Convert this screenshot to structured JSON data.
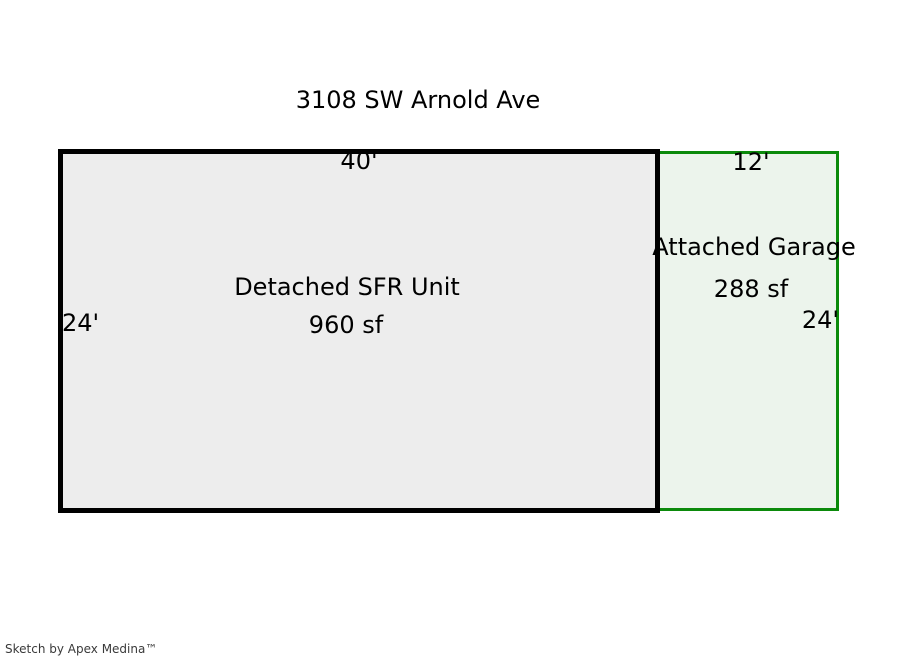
{
  "page": {
    "title": "3108 SW Arnold Ave",
    "footer_credit": "Sketch by Apex Medina™"
  },
  "sketch": {
    "main_unit": {
      "label": "Detached SFR Unit",
      "area": "960 sf",
      "top_dimension": "40'",
      "side_dimension": "24'"
    },
    "garage": {
      "label": "Attached Garage",
      "area": "288 sf",
      "top_dimension": "12'",
      "side_dimension": "24'"
    }
  },
  "colors": {
    "main_fill": "#ededed",
    "main_border": "#000000",
    "garage_fill": "#ecf4ec",
    "garage_border": "#0b8a0b",
    "text": "#000000",
    "footer_text": "#3a3a3a"
  }
}
